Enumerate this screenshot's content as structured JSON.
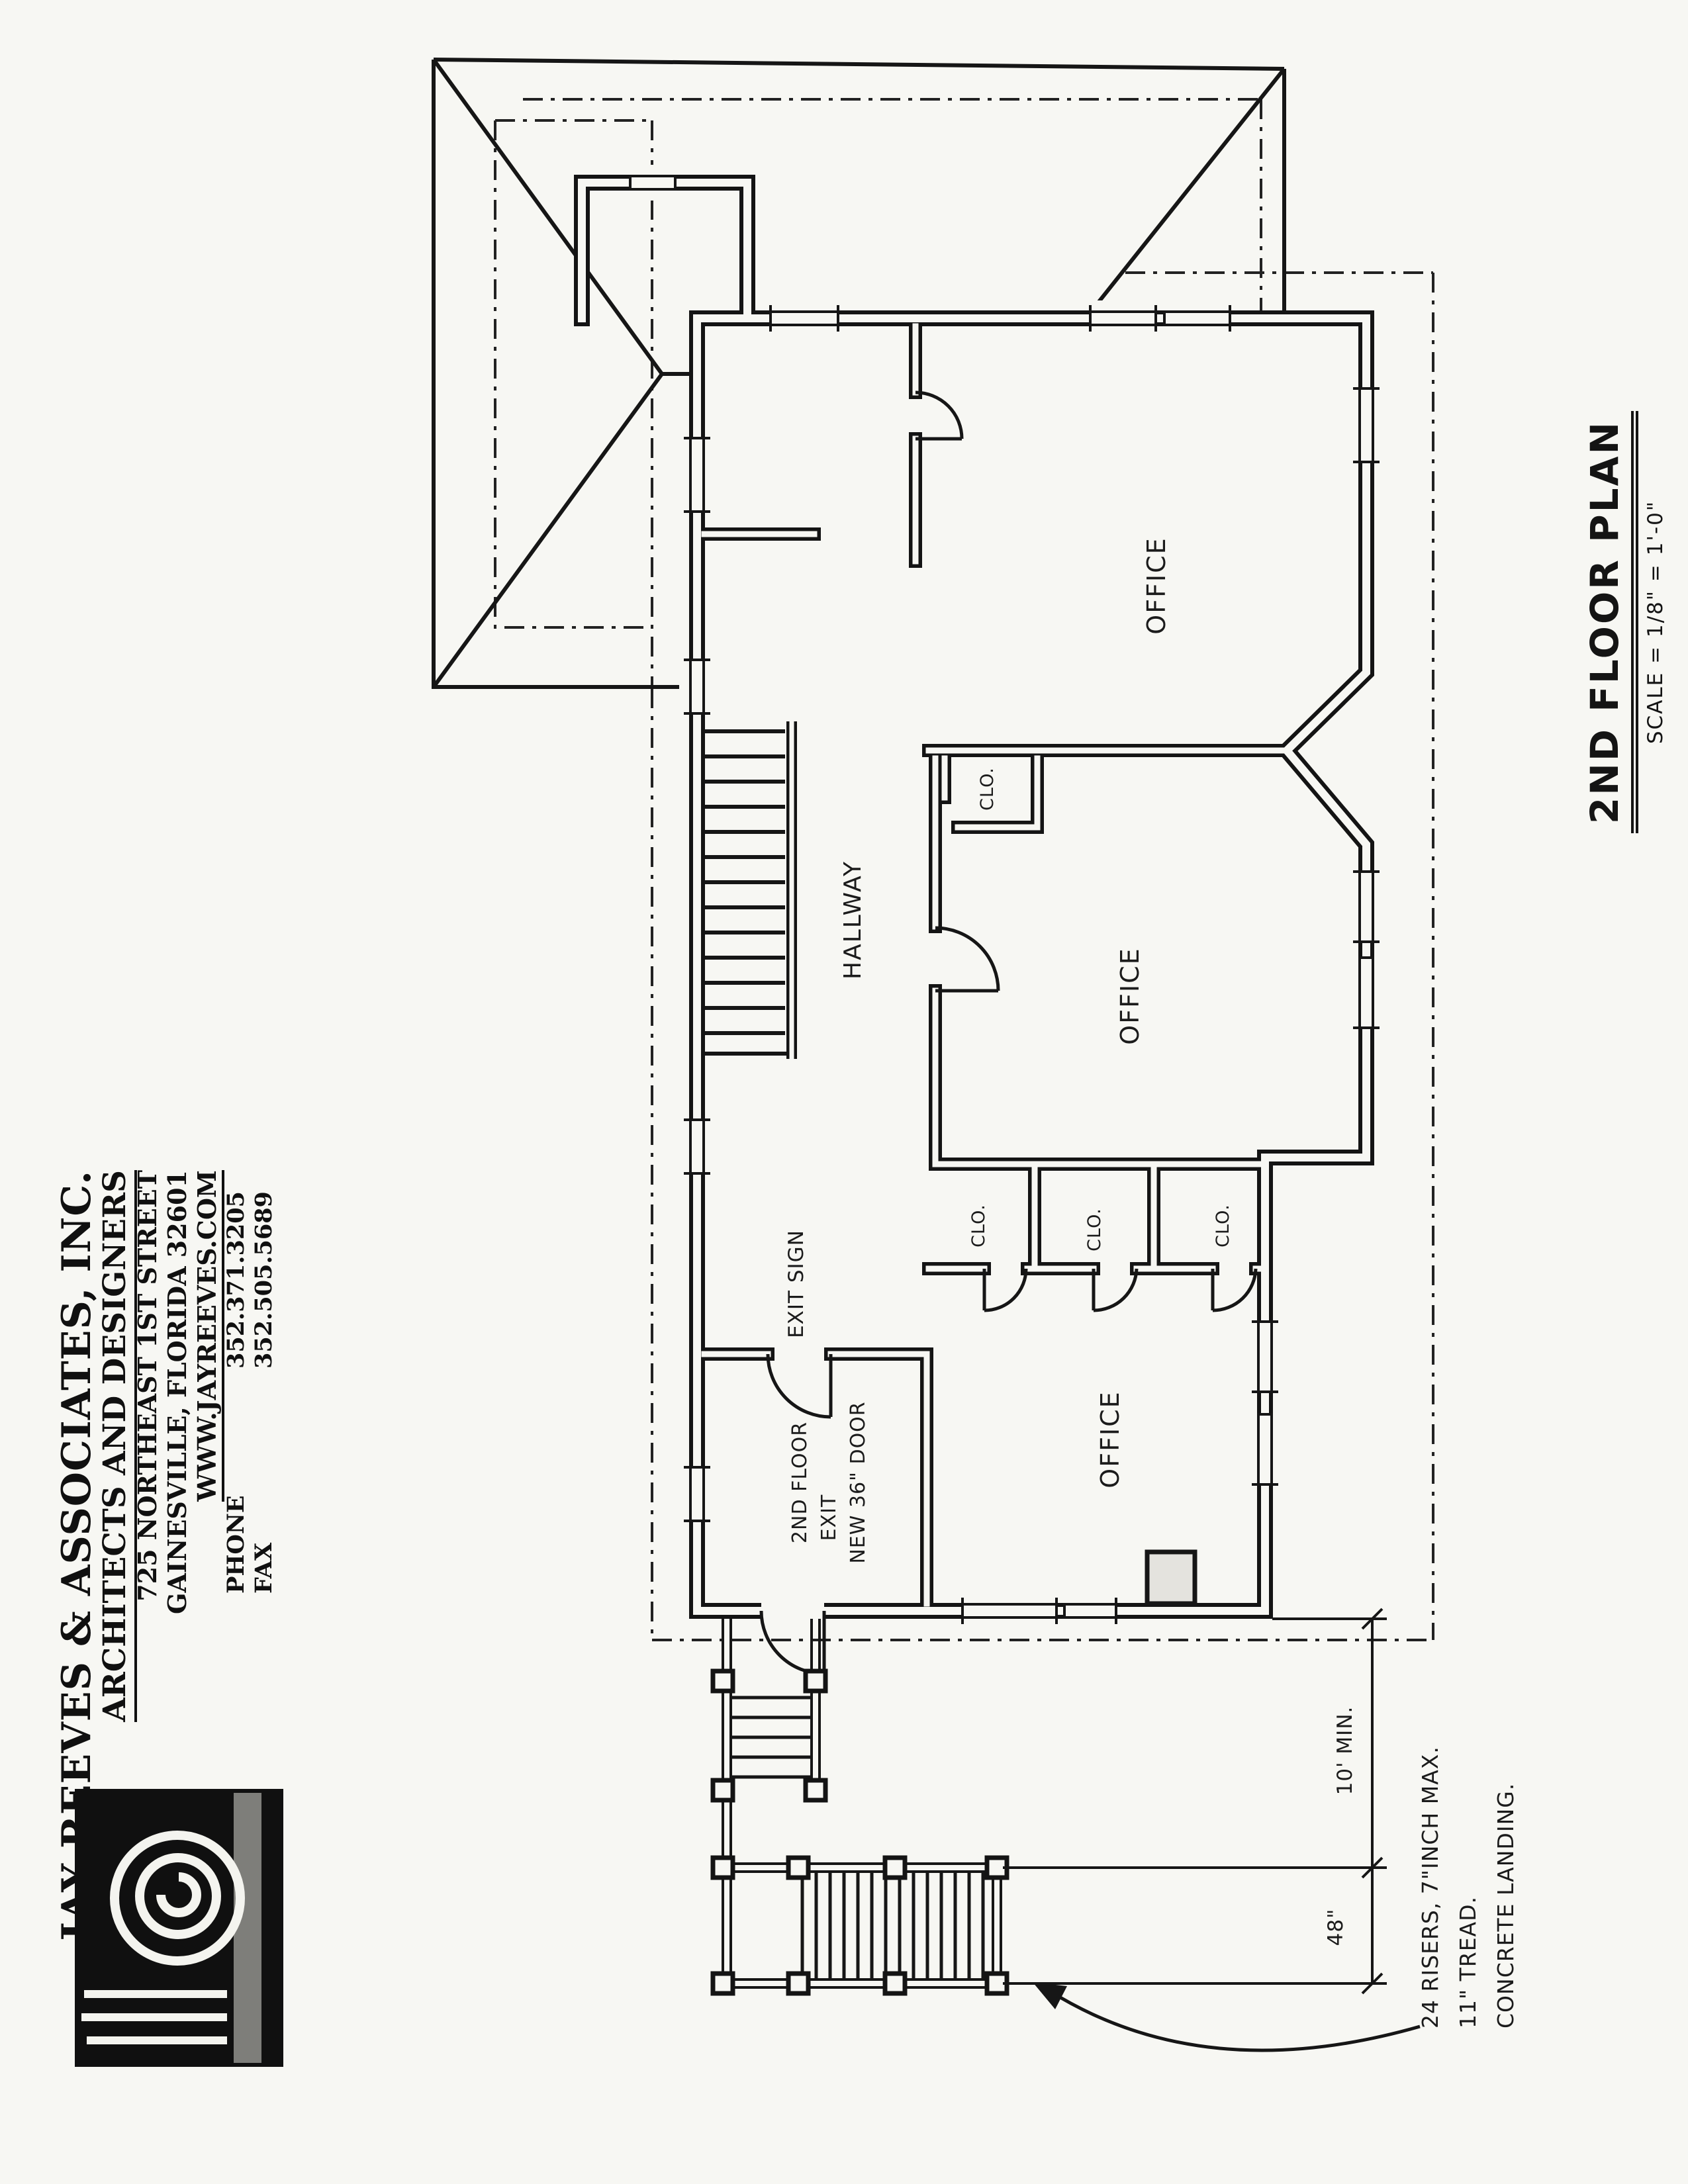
{
  "sheet": {
    "kind": "scanned architectural drawing",
    "paper_color": "#f7f7f3",
    "ink_color": "#1b1b1b"
  },
  "title_block": {
    "company": "JAY REEVES & ASSOCIATES, INC.",
    "tagline": "ARCHITECTS AND DESIGNERS",
    "address_line1": "725 NORTHEAST 1ST STREET",
    "address_line2": "GAINESVILLE, FLORIDA 32601",
    "website": "WWW.JAYREEVES.COM",
    "phone_label": "PHONE",
    "phone_number": "352.371.3205",
    "fax_label": "FAX",
    "fax_number": "352.505.5689",
    "logo": "spiral-column-volute"
  },
  "sheet_title": {
    "title": "2ND FLOOR PLAN",
    "scale": "SCALE = 1/8\" = 1'-0\""
  },
  "plan": {
    "room_labels": {
      "office_top": "OFFICE",
      "office_middle": "OFFICE",
      "office_bottom": "OFFICE",
      "hallway": "HALLWAY",
      "closet_small": "CLO.",
      "closet_1": "CLO.",
      "closet_2": "CLO.",
      "closet_3": "CLO."
    },
    "annotations": {
      "exit_sign": "EXIT SIGN",
      "exit_note_line1": "2ND FLOOR",
      "exit_note_line2": "EXIT",
      "exit_note_line3": "NEW 36\" DOOR",
      "stair_note_line1": "24 RISERS, 7\"INCH MAX.",
      "stair_note_line2": "11\" TREAD.",
      "stair_note_line3": "CONCRETE LANDING.",
      "landing_dim": "10' MIN.",
      "stair_width_dim": "48\""
    }
  }
}
